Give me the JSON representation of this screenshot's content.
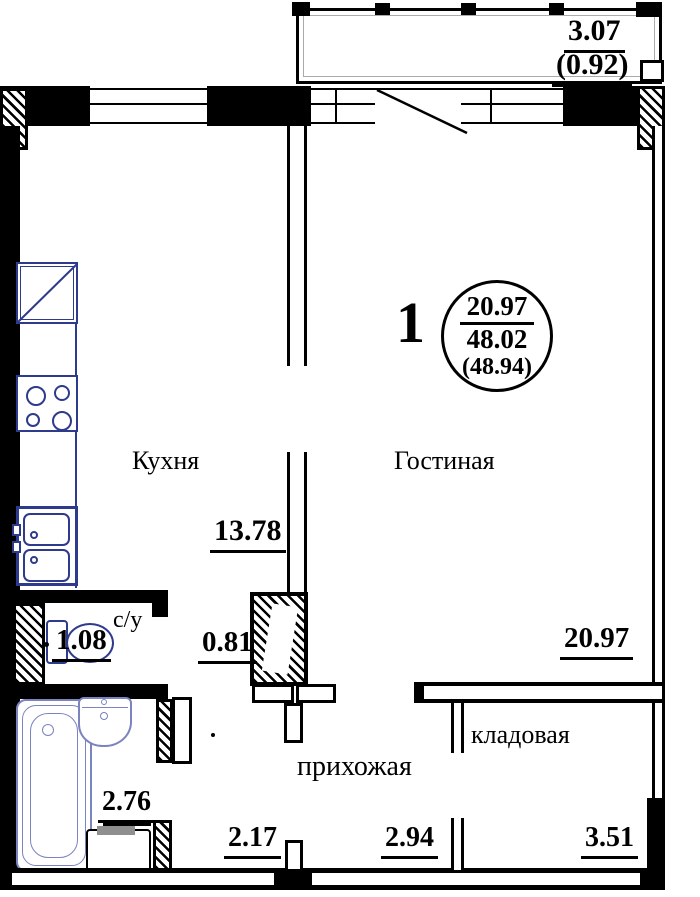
{
  "plan": {
    "stamp": {
      "apartment_number": "1",
      "living_area": "20.97",
      "total_area": "48.02",
      "area_with_balcony": "(48.94)"
    },
    "balcony": {
      "width": "3.07",
      "area": "(0.92)"
    },
    "rooms": {
      "kitchen": {
        "name": "Кухня",
        "dimension": "13.78"
      },
      "living": {
        "name": "Гостиная",
        "dimension": "20.97"
      },
      "wc": {
        "name": "с/у",
        "dimension": "1.08"
      },
      "hallway": {
        "name": "прихожая",
        "dimension_left": "2.17",
        "dimension_right": "2.94"
      },
      "storage": {
        "name": "кладовая",
        "dimension": "3.51"
      },
      "bathroom": {
        "dimension": "2.76"
      },
      "vent_shaft": {
        "dimension": "0.81"
      }
    },
    "fixture_icons": [
      "fridge-icon",
      "stove-icon",
      "kitchen-sink-icon",
      "toilet-icon",
      "bathtub-icon",
      "washbasin-icon",
      "washing-machine-icon"
    ],
    "colors": {
      "wall": "#000000",
      "kitchen_fixture": "#2e3a8c",
      "bath_fixture": "#7b83c0",
      "appliance_top_gray": "#8f8f8f"
    }
  }
}
